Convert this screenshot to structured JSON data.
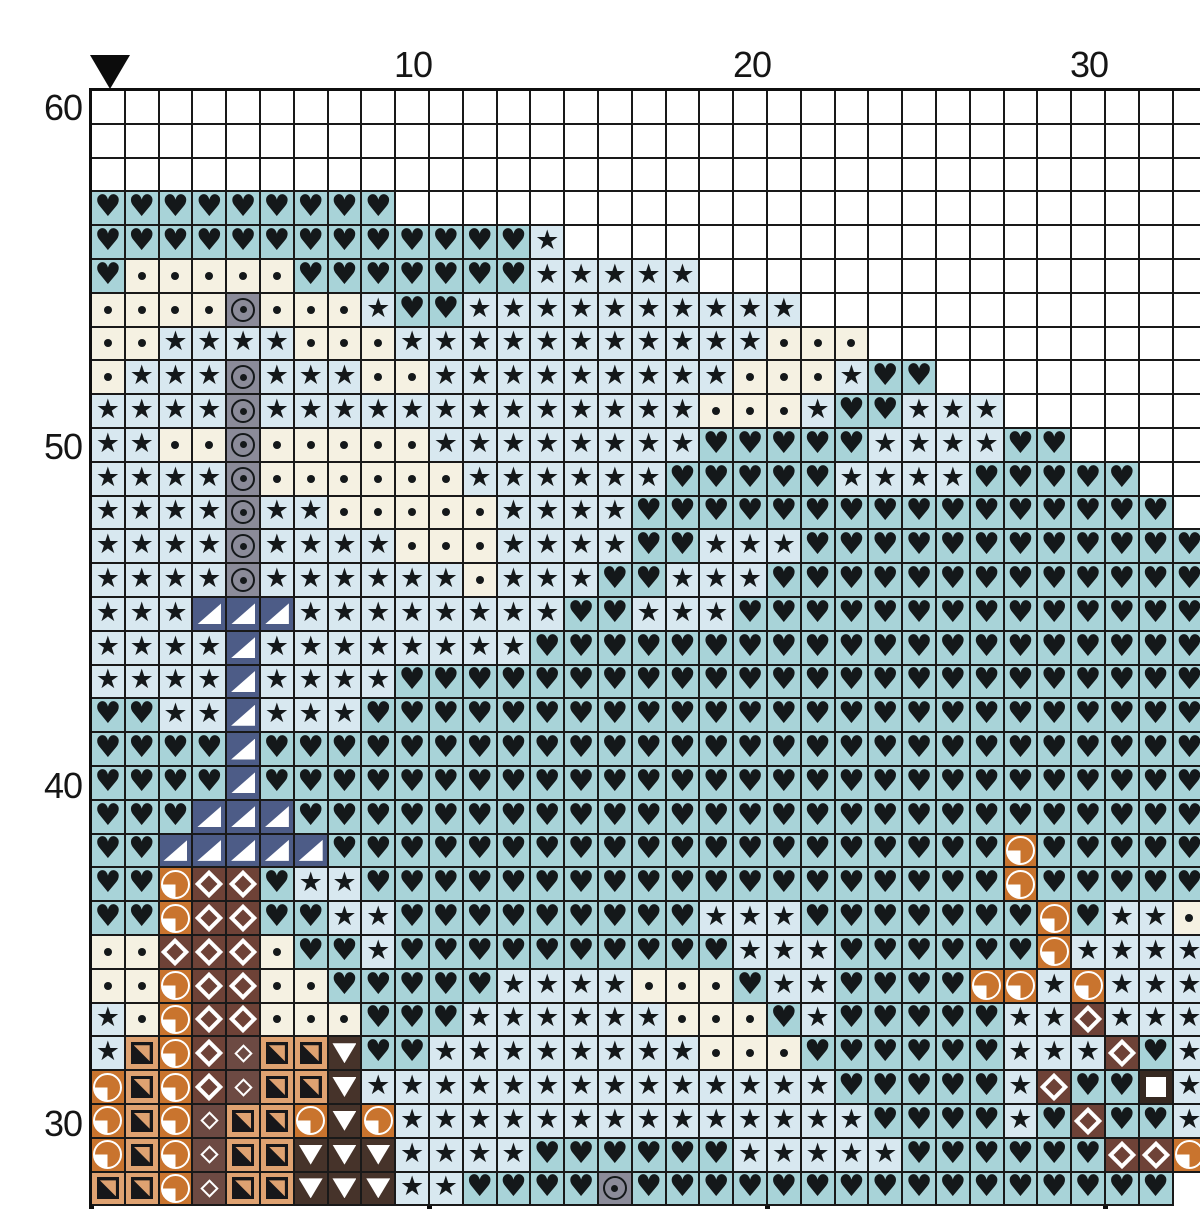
{
  "chart_data": {
    "type": "heatmap",
    "title": "cross-stitch pattern chart (grid of color/symbol stitches)",
    "axis": {
      "col_labels": [
        {
          "text": "10",
          "col": 10
        },
        {
          "text": "20",
          "col": 20
        },
        {
          "text": "30",
          "col": 30
        }
      ],
      "row_labels": [
        {
          "text": "60",
          "row": 60
        },
        {
          "text": "50",
          "row": 50
        },
        {
          "text": "40",
          "row": 40
        },
        {
          "text": "30",
          "row": 30
        }
      ]
    },
    "marker": {
      "symbol": "down-triangle",
      "color": "#0c0c0c",
      "col": 1
    },
    "grid_lines": {
      "thin_every": 1,
      "thick_every": 10,
      "color": "#151515"
    },
    "palette": {
      "W": {
        "name": "empty-white",
        "bg": "#ffffff",
        "symbol": "none",
        "symbol_color": ""
      },
      "H": {
        "name": "teal-heart",
        "bg": "#a8d3d8",
        "symbol": "heart",
        "glyph": "♥",
        "symbol_color": "#14181a"
      },
      "S": {
        "name": "light-blue-star",
        "bg": "#d8e8f0",
        "symbol": "star",
        "glyph": "★",
        "symbol_color": "#14181a"
      },
      "D": {
        "name": "cream-dot",
        "bg": "#f5f1e2",
        "symbol": "dot",
        "symbol_color": "#14181a"
      },
      "G": {
        "name": "gray-circled-dot",
        "bg": "#8b8b99",
        "symbol": "circle-dot",
        "symbol_color": "#14181a"
      },
      "N": {
        "name": "navy-corner-triangle",
        "bg": "#4d5c87",
        "symbol": "triangle-lower-right",
        "symbol_color": "#ffffff"
      },
      "O": {
        "name": "orange-quarter-circle",
        "bg": "#c9742e",
        "symbol": "quarter-circle",
        "symbol_color": "#ffffff"
      },
      "B": {
        "name": "brown-diamond",
        "bg": "#6e4237",
        "symbol": "diamond-outline",
        "symbol_color": "#ffffff"
      },
      "M": {
        "name": "maroon-small-diamond",
        "bg": "#6d4a43",
        "symbol": "small-diamond-outline",
        "symbol_color": "#ffffff"
      },
      "T": {
        "name": "tan-split-square",
        "bg": "#dfa271",
        "symbol": "square-diagonal",
        "symbol_color": "#17171a"
      },
      "C": {
        "name": "chocolate-down-triangle",
        "bg": "#46332a",
        "symbol": "triangle-down",
        "symbol_color": "#ffffff"
      },
      "Q": {
        "name": "dark-brown-white-square",
        "bg": "#362921",
        "symbol": "square-filled",
        "symbol_color": "#ffffff"
      }
    },
    "grid": {
      "cols": 33,
      "rows": [
        {
          "n": 60,
          "cells": "WWWWWWWWWWWWWWWWWWWWWWWWWWWWWWWWW"
        },
        {
          "n": 59,
          "cells": "WWWWWWWWWWWWWWWWWWWWWWWWWWWWWWWWW"
        },
        {
          "n": 58,
          "cells": "WWWWWWWWWWWWWWWWWWWWWWWWWWWWWWWWW"
        },
        {
          "n": 57,
          "cells": "HHHHHHHHHWWWWWWWWWWWWWWWWWWWWWWWW"
        },
        {
          "n": 56,
          "cells": "HHHHHHHHHHHHHSWWWWWWWWWWWWWWWWWWW"
        },
        {
          "n": 55,
          "cells": "HDDDDDHHHHHHHSSSSSWWWWWWWWWWWWWWW"
        },
        {
          "n": 54,
          "cells": "DDDDGDDDSHHSSSSSSSSSSWWWWWWWWWWWW"
        },
        {
          "n": 53,
          "cells": "DDSSSSDDDSSSSSSSSSSSDDDWWWWWWWWWW"
        },
        {
          "n": 52,
          "cells": "DSSSGSSSDDSSSSSSSSSDDDSHHWWWWWWWW"
        },
        {
          "n": 51,
          "cells": "SSSSGSSSSSSSSSSSSSDDDSHHSSSWWWWWW"
        },
        {
          "n": 50,
          "cells": "SSDDGDDDDDSSSSSSSSHHHHHSSSSHHWWWW"
        },
        {
          "n": 49,
          "cells": "SSSSGDDDDDDSSSSSSHHHHHSSSSHHHHHWW"
        },
        {
          "n": 48,
          "cells": "SSSSGSSDDDDDSSSSHHHHHHHHHHHHHHHHW"
        },
        {
          "n": 47,
          "cells": "SSSSGSSSSDDDSSSSHHSSSHHHHHHHHHHHH"
        },
        {
          "n": 46,
          "cells": "SSSSGSSSSSSDSSSHHSSSHHHHHHHHHHHHH"
        },
        {
          "n": 45,
          "cells": "SSSNNNSSSSSSSSHHSSSHHHHHHHHHHHHHH"
        },
        {
          "n": 44,
          "cells": "SSSSNSSSSSSSSHHHHHHHHHHHHHHHHHHHH"
        },
        {
          "n": 43,
          "cells": "SSSSNSSSSHHHHHHHHHHHHHHHHHHHHHHHH"
        },
        {
          "n": 42,
          "cells": "HHSSNSSSHHHHHHHHHHHHHHHHHHHHHHHHH"
        },
        {
          "n": 41,
          "cells": "HHHHNHHHHHHHHHHHHHHHHHHHHHHHHHHHH"
        },
        {
          "n": 40,
          "cells": "HHHHNHHHHHHHHHHHHHHHHHHHHHHHHHHHH"
        },
        {
          "n": 39,
          "cells": "HHHNNNHHHHHHHHHHHHHHHHHHHHHHHHHHH"
        },
        {
          "n": 38,
          "cells": "HHNNNNNHHHHHHHHHHHHHHHHHHHHOHHHH"
        },
        {
          "n": 37,
          "cells": "HHHOBBHSSHHHHHHHHHHHHHHHHHHHOHHHH"
        },
        {
          "n": 36,
          "cells": "HHHOBBHHSSHHHHHHHHHSSSHHHHHHHOHSS"
        },
        {
          "n": 35,
          "cells": "DDDBBBDHHSHHHHHHHHHHSSSHHHHHHOSSS"
        },
        {
          "n": 34,
          "cells": "SDDOBBDDHHHHHSSSSDDDHSSHHHHOOSOSS"
        },
        {
          "n": 33,
          "cells": "SSDOBBDDDHHHSSSSSSDDDHSHHHHHSSBSS"
        },
        {
          "n": 32,
          "cells": "SSTOBMTTCHHSSSSSSSSDDDHHHHHHSSSBH"
        },
        {
          "n": 31,
          "cells": "SOTOBMTTCSSSSSSSSSSSSSSHHHHHSBHHQ"
        },
        {
          "n": 30,
          "cells": "SOTOMTTOCOSSSSSSSSSSSSSSHHHHSHBHH"
        },
        {
          "n": 29,
          "cells": "SOTOMTTCCCSSSSHHHHHHSSSSSHHHHHHBB"
        },
        {
          "n": 28,
          "cells": "OTTOMTTCCCSSHHHHGHHHHHHHHHHHHHHHH"
        }
      ]
    }
  }
}
